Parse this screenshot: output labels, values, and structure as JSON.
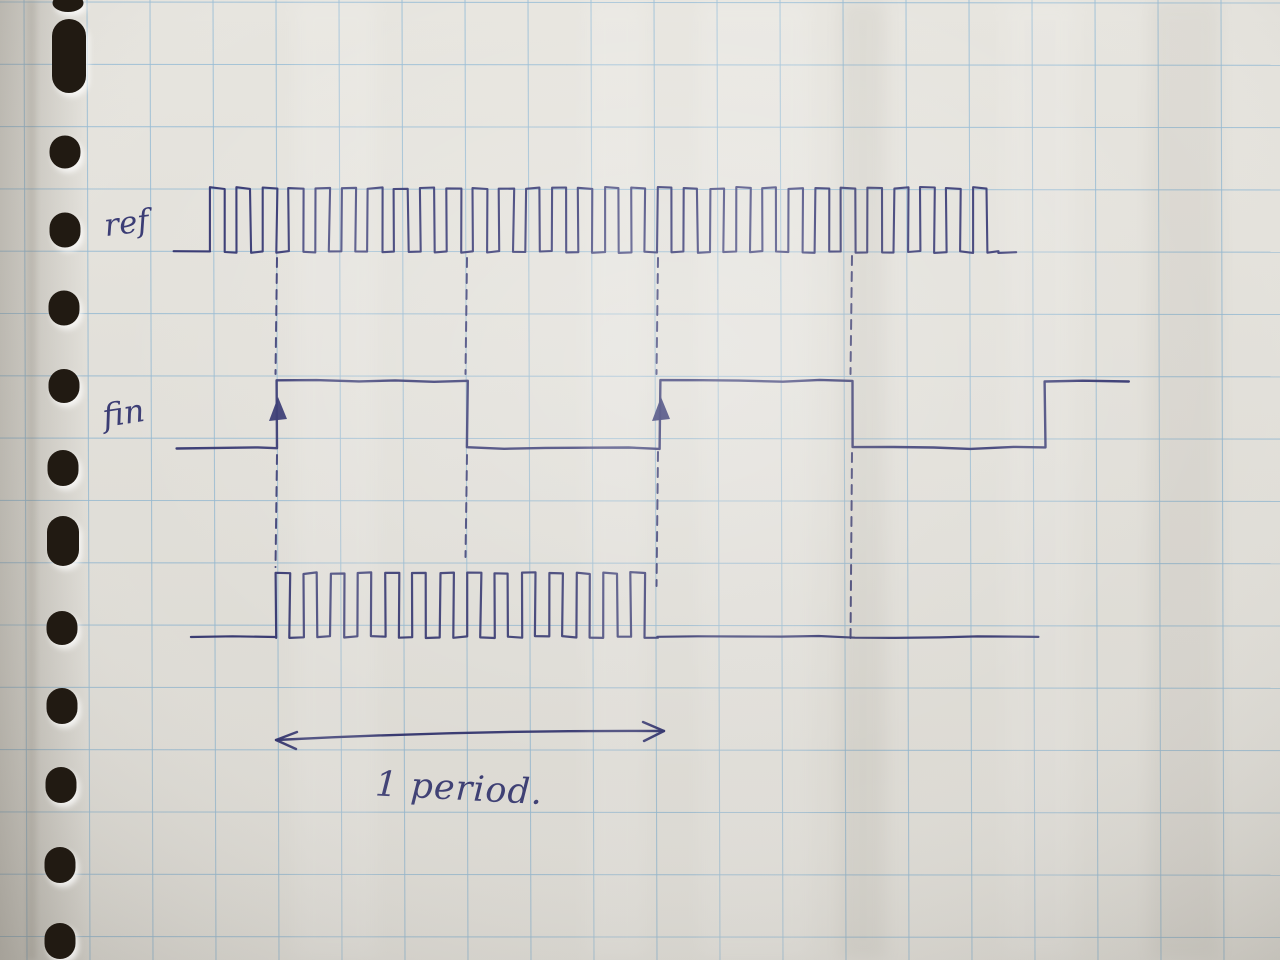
{
  "page": {
    "description": "Photograph of a squared notebook page with a hand-drawn timing diagram in blue ink; punched holes along the left edge",
    "paper_color": "#e7e5df",
    "grid_color": "#97bcd6",
    "ink_color": "#2b2d6d",
    "hole_color": "#211a12"
  },
  "labels": {
    "ref": "ref",
    "fin": "fin",
    "period": "1 period."
  },
  "diagram": {
    "grid": {
      "offset_x": 24,
      "spacing_x": 63,
      "offset_y": 2,
      "spacing_y": 62.3
    },
    "holes": [
      {
        "cx": 68,
        "cy": 3,
        "w": 31,
        "h": 18
      },
      {
        "cx": 69,
        "cy": 56,
        "w": 34,
        "h": 74
      },
      {
        "cx": 65,
        "cy": 152,
        "w": 31,
        "h": 33
      },
      {
        "cx": 65,
        "cy": 230,
        "w": 31,
        "h": 35
      },
      {
        "cx": 64,
        "cy": 308,
        "w": 31,
        "h": 35
      },
      {
        "cx": 64,
        "cy": 386,
        "w": 31,
        "h": 34
      },
      {
        "cx": 63,
        "cy": 468,
        "w": 31,
        "h": 36
      },
      {
        "cx": 63,
        "cy": 541,
        "w": 32,
        "h": 50
      },
      {
        "cx": 62,
        "cy": 628,
        "w": 31,
        "h": 34
      },
      {
        "cx": 62,
        "cy": 706,
        "w": 31,
        "h": 36
      },
      {
        "cx": 61,
        "cy": 785,
        "w": 31,
        "h": 36
      },
      {
        "cx": 60,
        "cy": 865,
        "w": 31,
        "h": 36
      },
      {
        "cx": 60,
        "cy": 941,
        "w": 31,
        "h": 36
      }
    ],
    "signals": [
      {
        "id": "ref",
        "baseline_y": 252,
        "high_y": 188,
        "stroke": 2.1,
        "segments": [
          {
            "type": "flat",
            "level": "low",
            "x0": 174,
            "x1": 210
          },
          {
            "type": "clock",
            "x0": 210,
            "x1": 998,
            "period": 26.3,
            "duty": 0.54
          },
          {
            "type": "flat",
            "level": "low",
            "x0": 998,
            "x1": 1016
          }
        ]
      },
      {
        "id": "fin",
        "baseline_y": 448,
        "high_y": 381,
        "stroke": 2.4,
        "arrows_up_x": [
          277,
          660
        ],
        "segments": [
          {
            "type": "flat",
            "level": "low",
            "x0": 176,
            "x1": 277
          },
          {
            "type": "flat",
            "level": "high",
            "x0": 277,
            "x1": 467
          },
          {
            "type": "flat",
            "level": "low",
            "x0": 467,
            "x1": 660
          },
          {
            "type": "flat",
            "level": "high",
            "x0": 660,
            "x1": 852
          },
          {
            "type": "flat",
            "level": "low",
            "x0": 852,
            "x1": 1045
          },
          {
            "type": "flat",
            "level": "high",
            "x0": 1045,
            "x1": 1128
          }
        ]
      },
      {
        "id": "gated",
        "baseline_y": 637,
        "high_y": 573,
        "stroke": 2.2,
        "segments": [
          {
            "type": "flat",
            "level": "low",
            "x0": 191,
            "x1": 276
          },
          {
            "type": "clock",
            "x0": 276,
            "x1": 658,
            "period": 27.3,
            "duty": 0.5
          },
          {
            "type": "flat",
            "level": "low",
            "x0": 658,
            "x1": 1038
          }
        ]
      }
    ],
    "guides": [
      {
        "x": 277,
        "spans": [
          [
            258,
            374
          ],
          [
            455,
            567
          ]
        ]
      },
      {
        "x": 467,
        "spans": [
          [
            258,
            374
          ],
          [
            455,
            557
          ]
        ]
      },
      {
        "x": 658,
        "spans": [
          [
            258,
            374
          ],
          [
            452,
            586
          ]
        ]
      },
      {
        "x": 852,
        "spans": [
          [
            256,
            374
          ],
          [
            453,
            641
          ]
        ]
      }
    ],
    "period_arrow": {
      "x0": 276,
      "y0": 740,
      "x1": 664,
      "y1": 731
    }
  }
}
